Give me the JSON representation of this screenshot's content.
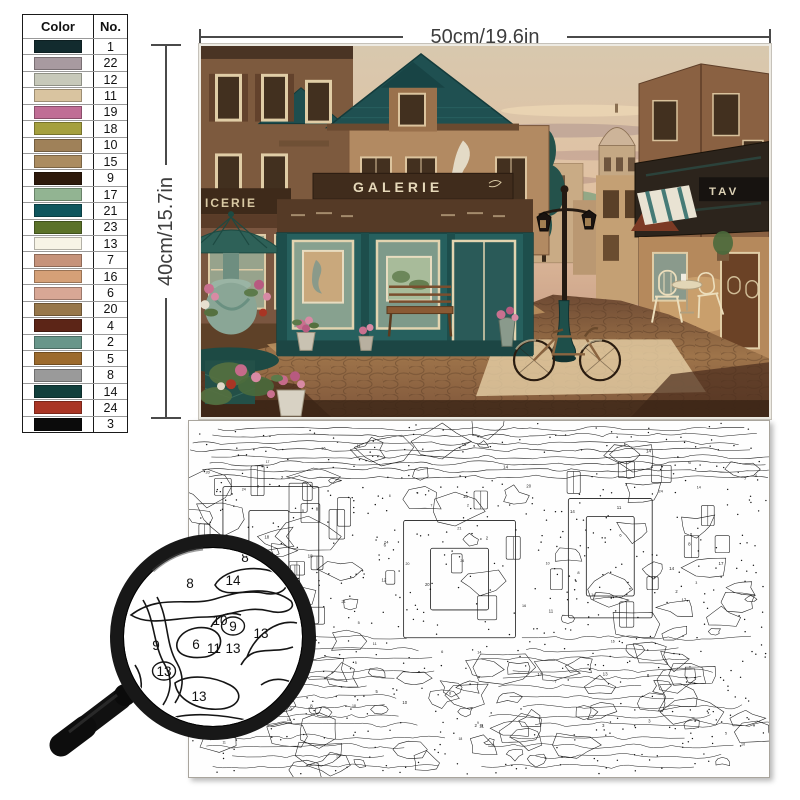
{
  "palette_table": {
    "col_color": "Color",
    "col_no": "No.",
    "rows": [
      {
        "color": "#122b2e",
        "no": "1"
      },
      {
        "color": "#a89aa0",
        "no": "22"
      },
      {
        "color": "#c7c9ba",
        "no": "12"
      },
      {
        "color": "#d9c4a0",
        "no": "11"
      },
      {
        "color": "#c06d95",
        "no": "19"
      },
      {
        "color": "#a5a03e",
        "no": "18"
      },
      {
        "color": "#9f8159",
        "no": "10"
      },
      {
        "color": "#ab8c60",
        "no": "15"
      },
      {
        "color": "#2d190b",
        "no": "9"
      },
      {
        "color": "#92b492",
        "no": "17"
      },
      {
        "color": "#0e565e",
        "no": "21"
      },
      {
        "color": "#5b7229",
        "no": "23"
      },
      {
        "color": "#f7f4e6",
        "no": "13"
      },
      {
        "color": "#c6937b",
        "no": "7"
      },
      {
        "color": "#d5a077",
        "no": "16"
      },
      {
        "color": "#d8a795",
        "no": "6"
      },
      {
        "color": "#97774a",
        "no": "20"
      },
      {
        "color": "#5c2517",
        "no": "4"
      },
      {
        "color": "#68968a",
        "no": "2"
      },
      {
        "color": "#9c6a2c",
        "no": "5"
      },
      {
        "color": "#9a9a9a",
        "no": "8"
      },
      {
        "color": "#113f3c",
        "no": "14"
      },
      {
        "color": "#a93524",
        "no": "24"
      },
      {
        "color": "#0b0b0b",
        "no": "3"
      }
    ]
  },
  "dimensions": {
    "width_label": "50cm/19.6in",
    "height_label": "40cm/15.7in"
  },
  "painting": {
    "signs": {
      "galerie": "GALERIE",
      "epicerie": "ICERIE",
      "taverne": "TAV"
    }
  },
  "magnifier": {
    "numbers": [
      {
        "label": "8",
        "x": 245,
        "y": 557,
        "circled": false
      },
      {
        "label": "14",
        "x": 233,
        "y": 580,
        "circled": false
      },
      {
        "label": "8",
        "x": 190,
        "y": 583,
        "circled": false
      },
      {
        "label": "10",
        "x": 220,
        "y": 620,
        "circled": false
      },
      {
        "label": "9",
        "x": 233,
        "y": 626,
        "circled": true
      },
      {
        "label": "13",
        "x": 261,
        "y": 633,
        "circled": false
      },
      {
        "label": "9",
        "x": 156,
        "y": 645,
        "circled": false
      },
      {
        "label": "6",
        "x": 196,
        "y": 644,
        "circled": false
      },
      {
        "label": "11",
        "x": 214,
        "y": 648,
        "circled": false
      },
      {
        "label": "13",
        "x": 233,
        "y": 648,
        "circled": false
      },
      {
        "label": "13",
        "x": 164,
        "y": 671,
        "circled": true
      },
      {
        "label": "13",
        "x": 199,
        "y": 696,
        "circled": false
      }
    ]
  },
  "canvas": {
    "number_pool": [
      "13",
      "8",
      "9",
      "14",
      "6",
      "11",
      "10",
      "24",
      "5",
      "2",
      "17",
      "21",
      "3",
      "7",
      "16",
      "20",
      "12",
      "18"
    ]
  }
}
